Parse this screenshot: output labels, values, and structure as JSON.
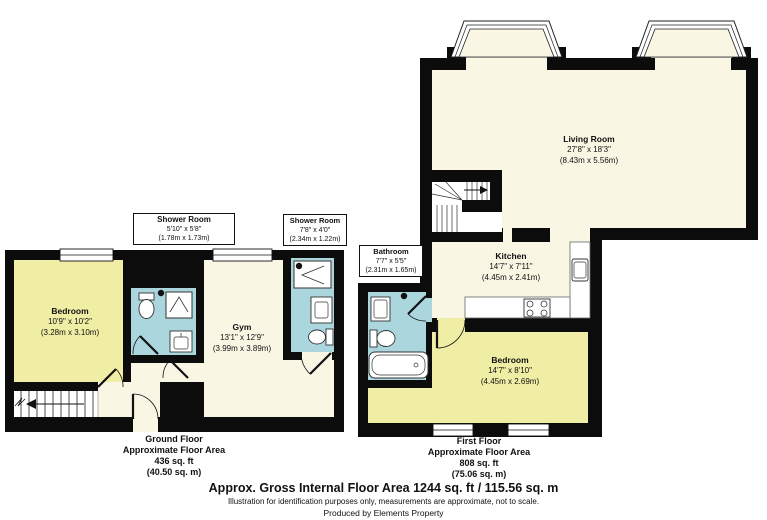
{
  "page": {
    "footer": {
      "title": "Approx. Gross Internal Floor Area 1244 sq. ft / 115.56 sq. m",
      "disclaimer": "Illustration for identification purposes only, measurements are approximate, not to scale.",
      "producer": "Produced by Elements Property"
    }
  },
  "colors": {
    "wall": "#0c0c0c",
    "room_cream": "#faf6e4",
    "room_yellow": "#f0eda4",
    "room_blue": "#abd6de",
    "background": "#ffffff"
  },
  "ground_floor": {
    "summary": {
      "floor_name": "Ground Floor",
      "area_label": "Approximate Floor Area",
      "area_imperial": "436 sq. ft",
      "area_metric": "(40.50 sq. m)"
    },
    "rooms": {
      "bedroom": {
        "name": "Bedroom",
        "size_imperial": "10'9\" x 10'2\"",
        "size_metric": "(3.28m x 3.10m)"
      },
      "shower_room_1": {
        "name": "Shower Room",
        "size_imperial": "5'10\" x 5'8\"",
        "size_metric": "(1.78m x 1.73m)"
      },
      "gym": {
        "name": "Gym",
        "size_imperial": "13'1\" x 12'9\"",
        "size_metric": "(3.99m x 3.89m)"
      },
      "shower_room_2": {
        "name": "Shower Room",
        "size_imperial": "7'8\" x 4'0\"",
        "size_metric": "(2.34m x 1.22m)"
      }
    }
  },
  "first_floor": {
    "summary": {
      "floor_name": "First Floor",
      "area_label": "Approximate Floor Area",
      "area_imperial": "808 sq. ft",
      "area_metric": "(75.06 sq. m)"
    },
    "rooms": {
      "living_room": {
        "name": "Living Room",
        "size_imperial": "27'8\" x 18'3\"",
        "size_metric": "(8.43m x 5.56m)"
      },
      "kitchen": {
        "name": "Kitchen",
        "size_imperial": "14'7\" x 7'11\"",
        "size_metric": "(4.45m x 2.41m)"
      },
      "bathroom": {
        "name": "Bathroom",
        "size_imperial": "7'7\" x 5'5\"",
        "size_metric": "(2.31m x 1.65m)"
      },
      "bedroom": {
        "name": "Bedroom",
        "size_imperial": "14'7\" x 8'10\"",
        "size_metric": "(4.45m x 2.69m)"
      }
    }
  }
}
